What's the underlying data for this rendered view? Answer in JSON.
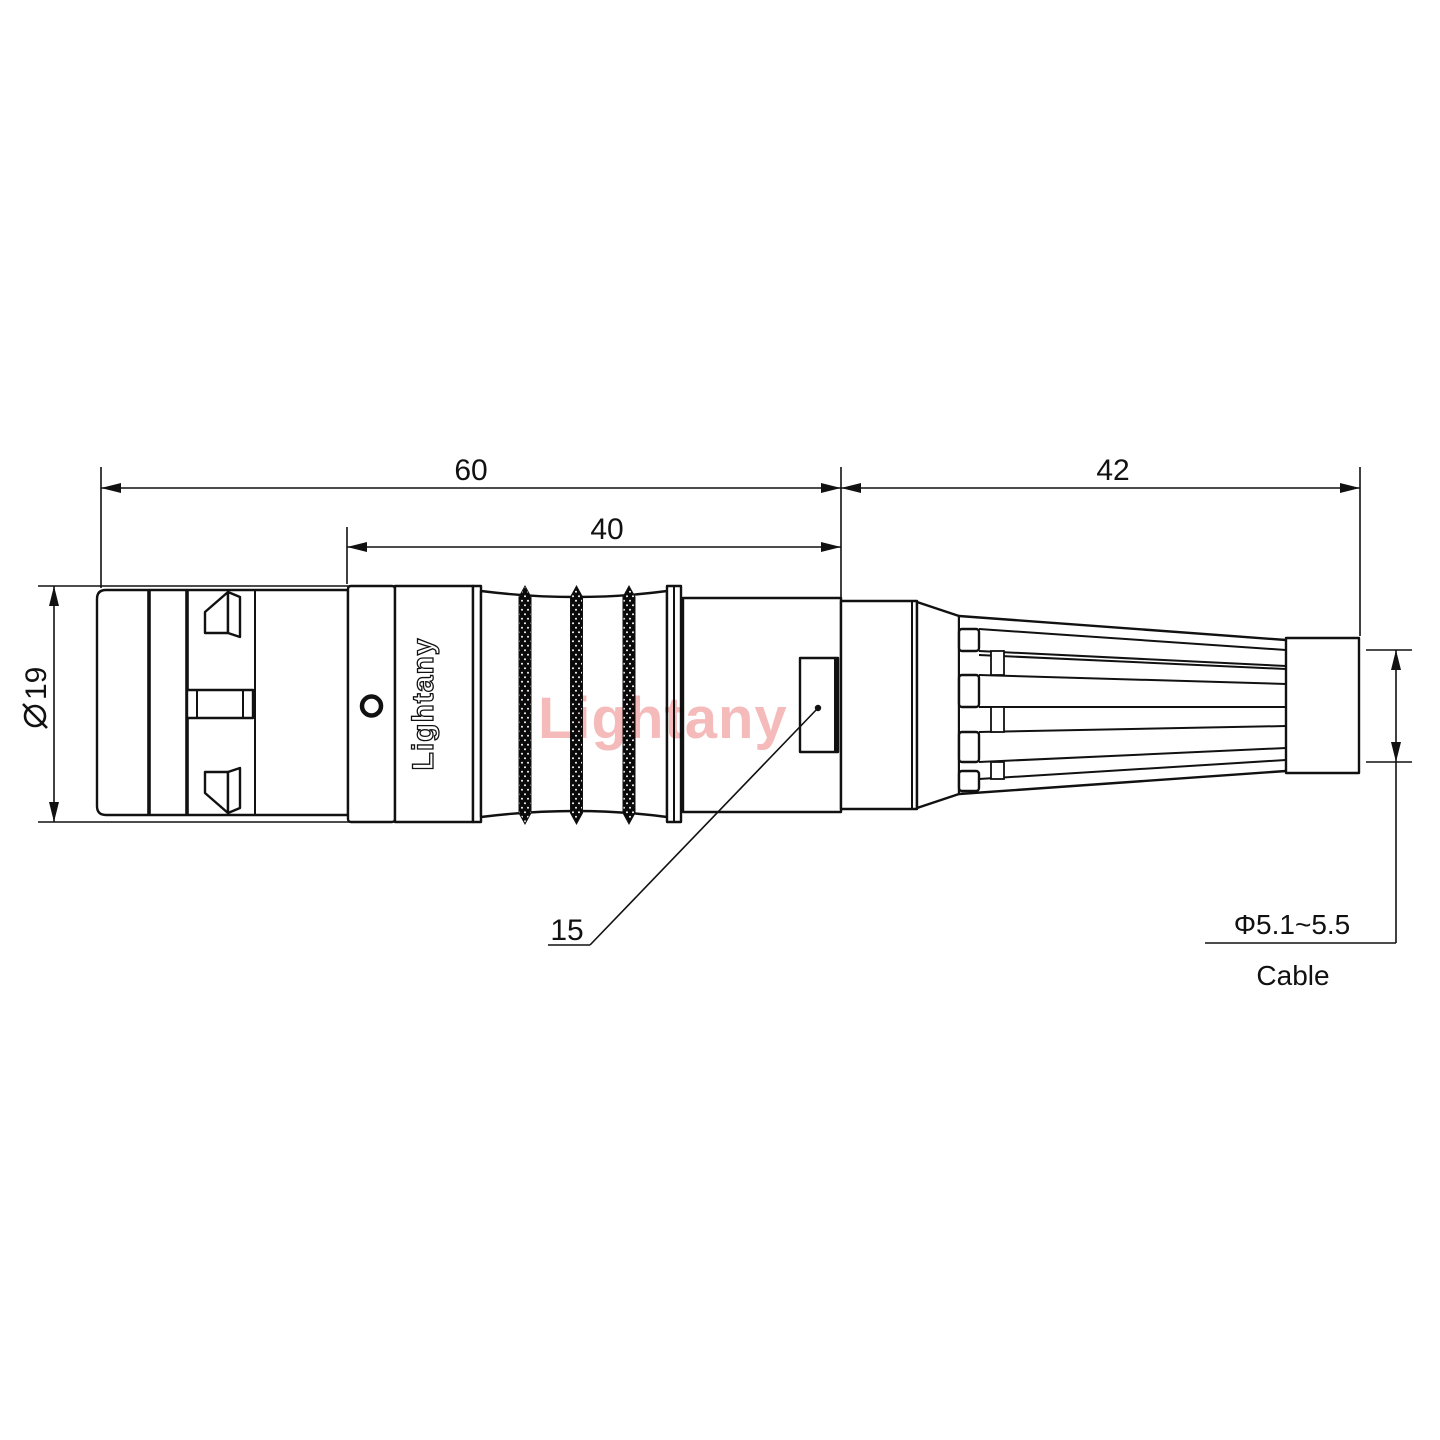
{
  "watermark": {
    "text": "Lightany",
    "color": "#f5baba"
  },
  "connector": {
    "marking": "Lightany"
  },
  "dimensions": {
    "overall_length": {
      "value": "60"
    },
    "grip_length": {
      "value": "40"
    },
    "boot_length": {
      "value": "42"
    },
    "shell_diameter": {
      "symbol": "ø",
      "value": "19"
    },
    "key_feature": {
      "value": "15"
    },
    "cable": {
      "diameter_range": "Φ5.1~5.5",
      "label": "Cable"
    }
  },
  "colors": {
    "line": "#111111",
    "watermark": "#f5baba"
  }
}
